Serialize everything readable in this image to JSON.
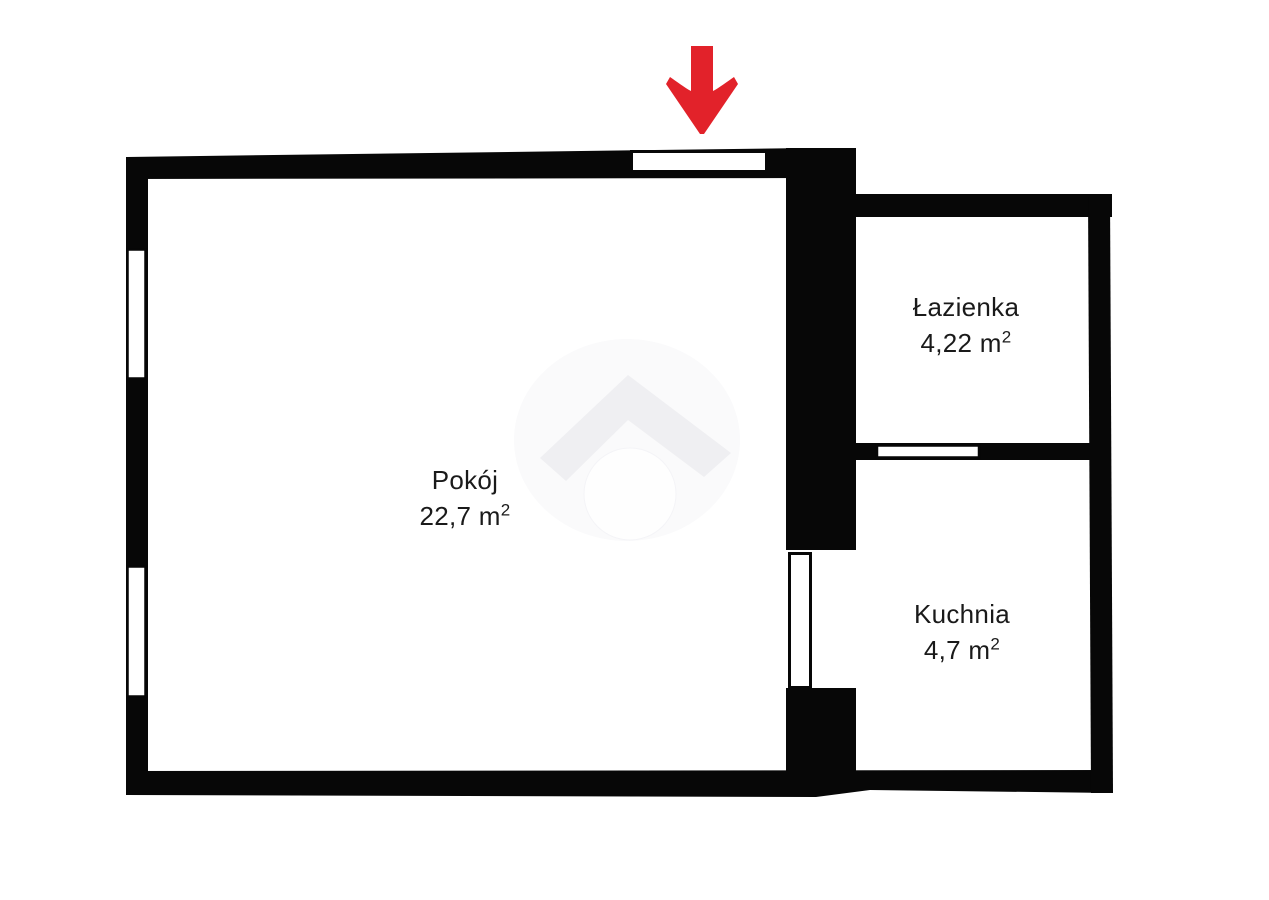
{
  "floorplan": {
    "rooms": [
      {
        "name": "Pokój",
        "area_value": "22,7 m",
        "area_superscript": "2"
      },
      {
        "name": "Łazienka",
        "area_value": "4,22 m",
        "area_superscript": "2"
      },
      {
        "name": "Kuchnia",
        "area_value": "4,7 m",
        "area_superscript": "2"
      }
    ],
    "icons": {
      "entrance_arrow_icon": "red-down-arrow",
      "watermark_icon": "house-roof-logo-watermark"
    },
    "colors": {
      "walls": "#070707",
      "entrance_arrow": "#e2222a",
      "room_text": "#1a1a1a",
      "watermark_roof": "#efeff2",
      "watermark_blob": "#fafafb",
      "watermark_circle": "#fefefe",
      "background": "#ffffff"
    }
  }
}
